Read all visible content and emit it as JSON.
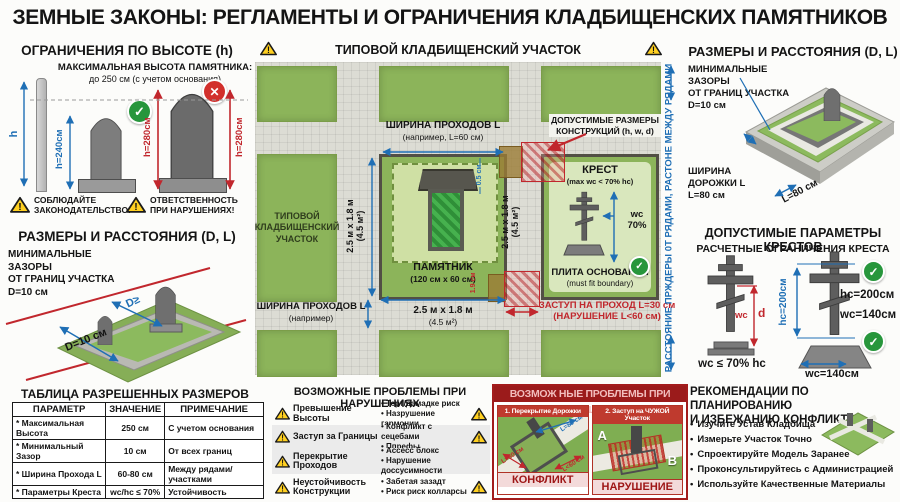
{
  "icons": {
    "exclaim": "!",
    "check": "✓",
    "x_mark": "✕",
    "bullet": "•"
  },
  "palette": {
    "red": "#c1272d",
    "blue": "#1f6fb5",
    "green": "#8cb45a",
    "path_gray": "#dcdcd4",
    "warn_yellow": "#ffd021"
  },
  "header": {
    "title": "ЗЕМНЫЕ ЗАКОНЫ: РЕГЛАМЕНТЫ И ОГРАНИЧЕНИЯ КЛАДБИЩЕНСКИХ ПАМЯТНИКОВ"
  },
  "height_limits": {
    "heading": "ОГРАНИЧЕНИЯ ПО ВЫСОТЕ (h)",
    "max_title": "МАКСИМАЛЬНАЯ ВЫСОТА ПАМЯТНИКА:",
    "max_value": "до 250 см (с учетом основания)",
    "pole_label": "h",
    "ok_dim": "h=240см",
    "bad_dim_left": "h=280см",
    "bad_dim_right": "h=280см",
    "warn_left": "СОБЛЮДАЙТЕ\nЗАКОНОДАТЕЛЬСТВО!",
    "warn_right": "ОТВЕТСТВЕННОСТЬ\nПРИ НАРУШЕНИЯХ!"
  },
  "left_clearances": {
    "heading": "РАЗМЕРЫ И РАССТОЯНИЯ (D, L)",
    "note": "МИНИМАЛЬНЫЕ ЗАЗОРЫ\nОТ ГРАНИЦ УЧАСТКА\nD=10 см",
    "inner_dim": "D≥",
    "outer_dim": "D=10 см"
  },
  "plot_map": {
    "heading": "ТИПОВОЙ КЛАДБИЩЕНСКИЙ УЧАСТОК",
    "plot_label": "ТИПОВОЙ\nКЛАДБИЩЕНСКИЙ\nУЧАСТОК",
    "passage_top_1": "ШИРИНА ПРОХОДОВ L",
    "passage_top_2": "(например, L=60 см)",
    "passage_bottom_1": "ШИРИНА ПРОХОДОВ L",
    "passage_bottom_2": "(например)",
    "dims_side": "2.5 м x 1.8 м\n(4.5 м²)",
    "dims_side2": "2.5 м x 1.8 м\n(4.5 м²)",
    "dims_bottom_1": "2.5 м x 1.8 м",
    "dims_bottom_2": "(4.5 м²)",
    "monument_name": "ПАМЯТНИК",
    "monument_size": "(120 см x 60 см)",
    "gap_top": "0.5 см",
    "gap_bottom": "1.9 см",
    "allowed_box": "ДОПУСТИМЫЕ РАЗМЕРЫ\nКОНСТРУКЦИЙ (h, w, d)",
    "cross_name": "КРЕСТ",
    "cross_rule": "(max wc < 70% hc)",
    "cross_wc": "wc\n70%",
    "plate_name": "ПЛИТА ОСНОВАНИЯ",
    "plate_note": "(must fit boundary)",
    "violation": "ЗАСТУП НА ПРОХОД L=30 см\n(НАРУШЕНИЕ L<60 см)",
    "side_note": "РАССТОЯНИЕ ПРЖДЕРЫ 0Т РЯДАМИ, РАСТОНЕ МЕЖДУ РЯДАМИ"
  },
  "right_clearances": {
    "heading": "РАЗМЕРЫ И РАССТОЯНИЯ (D, L)",
    "note": "МИНИМАЛЬНЫЕ ЗАЗОРЫ\nОТ ГРАНИЦ УЧАСТКА\nD=10 см",
    "path_note": "ШИРИНА\nДОРОЖКИ L\nL=80 см",
    "path_dim": "L=80 см"
  },
  "cross_params": {
    "heading": "ДОПУСТИМЫЕ ПАРАМЕТРЫ КРЕСТОВ",
    "subheading": "РАСЧЕТНЫЕ ОГРАНИЧЕНИЯ КРЕСТА",
    "wc_label": "wc",
    "d_label": "d",
    "rule": "wc ≤ 70% hc",
    "hc_rotated": "hc=200см",
    "hc_value": "hc=200см",
    "wc_value": "wc=140см",
    "base_width": "wc=140см"
  },
  "size_table": {
    "heading": "ТАБЛИЦА РАЗРЕШЕННЫХ РАЗМЕРОВ",
    "headers": [
      "ПАРАМЕТР",
      "ЗНАЧЕНИЕ",
      "ПРИМЕЧАНИЕ"
    ],
    "rows": [
      {
        "param": "* Максимальная Высота",
        "value": "250 см",
        "note": "С учетом основания"
      },
      {
        "param": "* Минимальный Зазор",
        "value": "10 см",
        "note": "От всех границ"
      },
      {
        "param": "* Ширина Прохода L",
        "value": "60-80 см",
        "note": "Между рядами/участками"
      },
      {
        "param": "* Параметры Креста",
        "value": "wc/hc ≤ 70%",
        "note": "Устойчивость"
      }
    ]
  },
  "problems": {
    "heading": "ВОЗМОЖНЫЕ ПРОБЛЕМЫ ПРИ НАРУШЕНИЯХ",
    "items": [
      {
        "label": "Превышение Высоты",
        "bullets": [
          "Терт/дамадке риск",
          "Назрушение гармонии"
        ]
      },
      {
        "label": "Заступ за Границы",
        "bullets": [
          "Конфликт с сецебами",
          "Ппрефы"
        ]
      },
      {
        "label": "Перекрытие Проходов",
        "bullets": [
          "Ассесс блокс",
          "Нарушение доссусимности"
        ]
      },
      {
        "label": "Неустойчивость Конструкции",
        "bullets": [
          "Забетая зазадт",
          "Риск риск колларсы"
        ]
      }
    ]
  },
  "red_panel": {
    "heading": "ВОЗМОЖ НЫЕ ПРОБЛЕМЫ ПРИ НАРУШЕНИХ",
    "case1": {
      "title": "1. Перекрытие Дорожки",
      "dim_top": "L=80 см",
      "dim_left": "L=80 см",
      "dim_right": "L<60 см",
      "verdict": "КОНФЛИКТ"
    },
    "case2": {
      "title": "2. Заступ на ЧУЖОЙ Участок",
      "zone_a": "A",
      "zone_b": "B",
      "verdict": "НАРУШЕНИЕ"
    }
  },
  "recommendations": {
    "heading": "РЕКОМЕНДАЦИИ ПО ПЛАНИРОВАНИЮ\nИ ИЗБЕЖАНИЮ КОНФЛИКТОВ",
    "items": [
      "Изучите Устав Кладбища",
      "Измерьте Участок Точно",
      "Спроектируйте Модель Заранее",
      "Проконсультируйтесь с Администрацией",
      "Используйте Качественные Материалы"
    ]
  }
}
